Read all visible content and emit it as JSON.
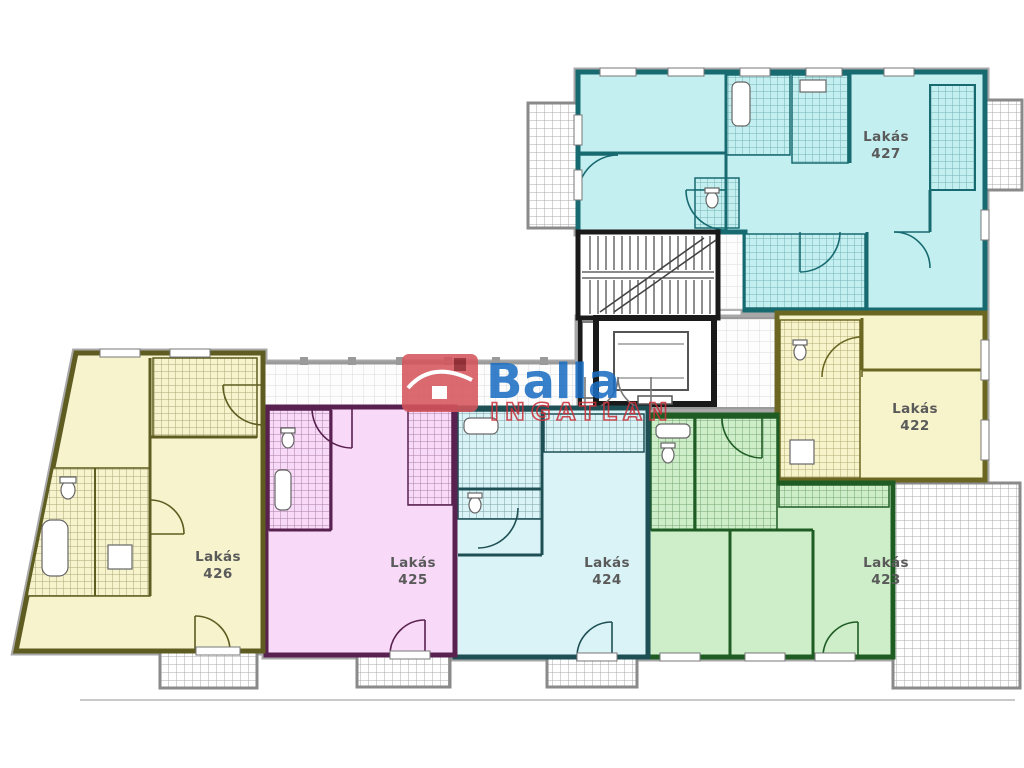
{
  "plan": {
    "background": "#ffffff",
    "corridor_color": "#f5f5f5",
    "outline_color": "#a8a8a8",
    "stair_wall_color": "#1a1a1a"
  },
  "logo": {
    "brand": "Balla",
    "sub": "INGATLAN",
    "brand_color": "#1b6ec2",
    "sub_color": "#c9303a",
    "house_color": "#d5555c",
    "chimney_color": "#8e1f26"
  },
  "apartments": [
    {
      "label": "Lakás",
      "number": "427",
      "fill": "#c3eff1",
      "wall": "#176a70"
    },
    {
      "label": "Lakás",
      "number": "422",
      "fill": "#f7f3cb",
      "wall": "#6b6722"
    },
    {
      "label": "Lakás",
      "number": "423",
      "fill": "#cdeec8",
      "wall": "#1f5c24"
    },
    {
      "label": "Lakás",
      "number": "424",
      "fill": "#daf3f6",
      "wall": "#1d4f55"
    },
    {
      "label": "Lakás",
      "number": "425",
      "fill": "#f8daf8",
      "wall": "#59214f"
    },
    {
      "label": "Lakás",
      "number": "426",
      "fill": "#f6f3cd",
      "wall": "#5e5c20"
    }
  ]
}
